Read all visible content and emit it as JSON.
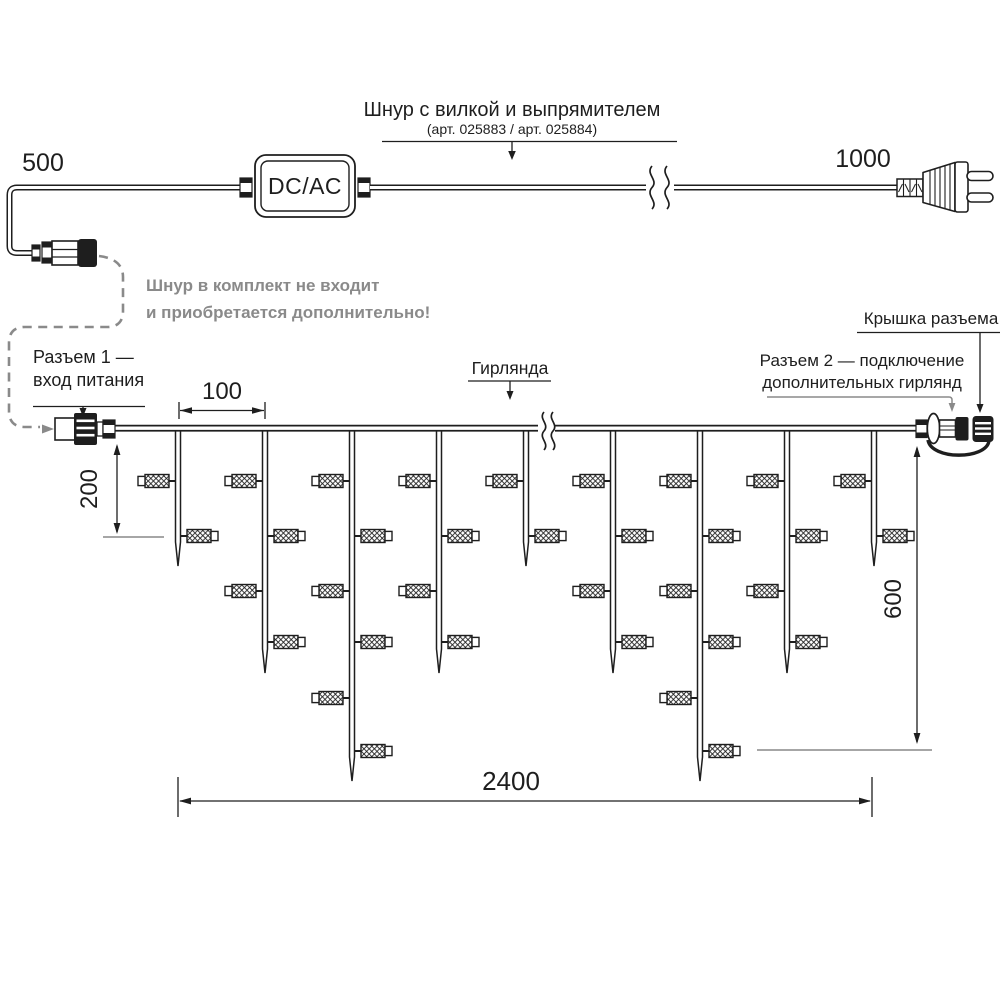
{
  "top": {
    "len_left": "500",
    "len_right": "1000",
    "adapter": "DC/AC",
    "cord_title": "Шнур с вилкой и выпрямителем",
    "cord_subtitle": "(арт. 025883 / арт. 025884)",
    "note1": "Шнур в комплект не входит",
    "note2": "и приобретается дополнительно!"
  },
  "garland": {
    "label": "Гирлянда",
    "conn1_l1": "Разъем 1 —",
    "conn1_l2": "вход питания",
    "conn2_l1": "Разъем 2 — подключение",
    "conn2_l2": "дополнительных гирлянд",
    "cap_label": "Крышка разъема",
    "led_row_y": [
      481,
      536,
      591,
      642,
      698,
      751
    ],
    "drops": [
      {
        "x": 178,
        "tip": 566,
        "leds": 2
      },
      {
        "x": 265,
        "tip": 673,
        "leds": 4
      },
      {
        "x": 352,
        "tip": 781,
        "leds": 6
      },
      {
        "x": 439,
        "tip": 673,
        "leds": 4
      },
      {
        "x": 526,
        "tip": 566,
        "leds": 2
      },
      {
        "x": 613,
        "tip": 673,
        "leds": 4
      },
      {
        "x": 700,
        "tip": 781,
        "leds": 6
      },
      {
        "x": 787,
        "tip": 673,
        "leds": 4
      },
      {
        "x": 874,
        "tip": 566,
        "leds": 2
      }
    ]
  },
  "dims": {
    "spacing": "100",
    "first_drop": "200",
    "max_drop": "600",
    "total": "2400"
  },
  "colors": {
    "ink": "#1e1e1e",
    "gray": "#8a8a8a",
    "ref": "#9a9a9a"
  }
}
